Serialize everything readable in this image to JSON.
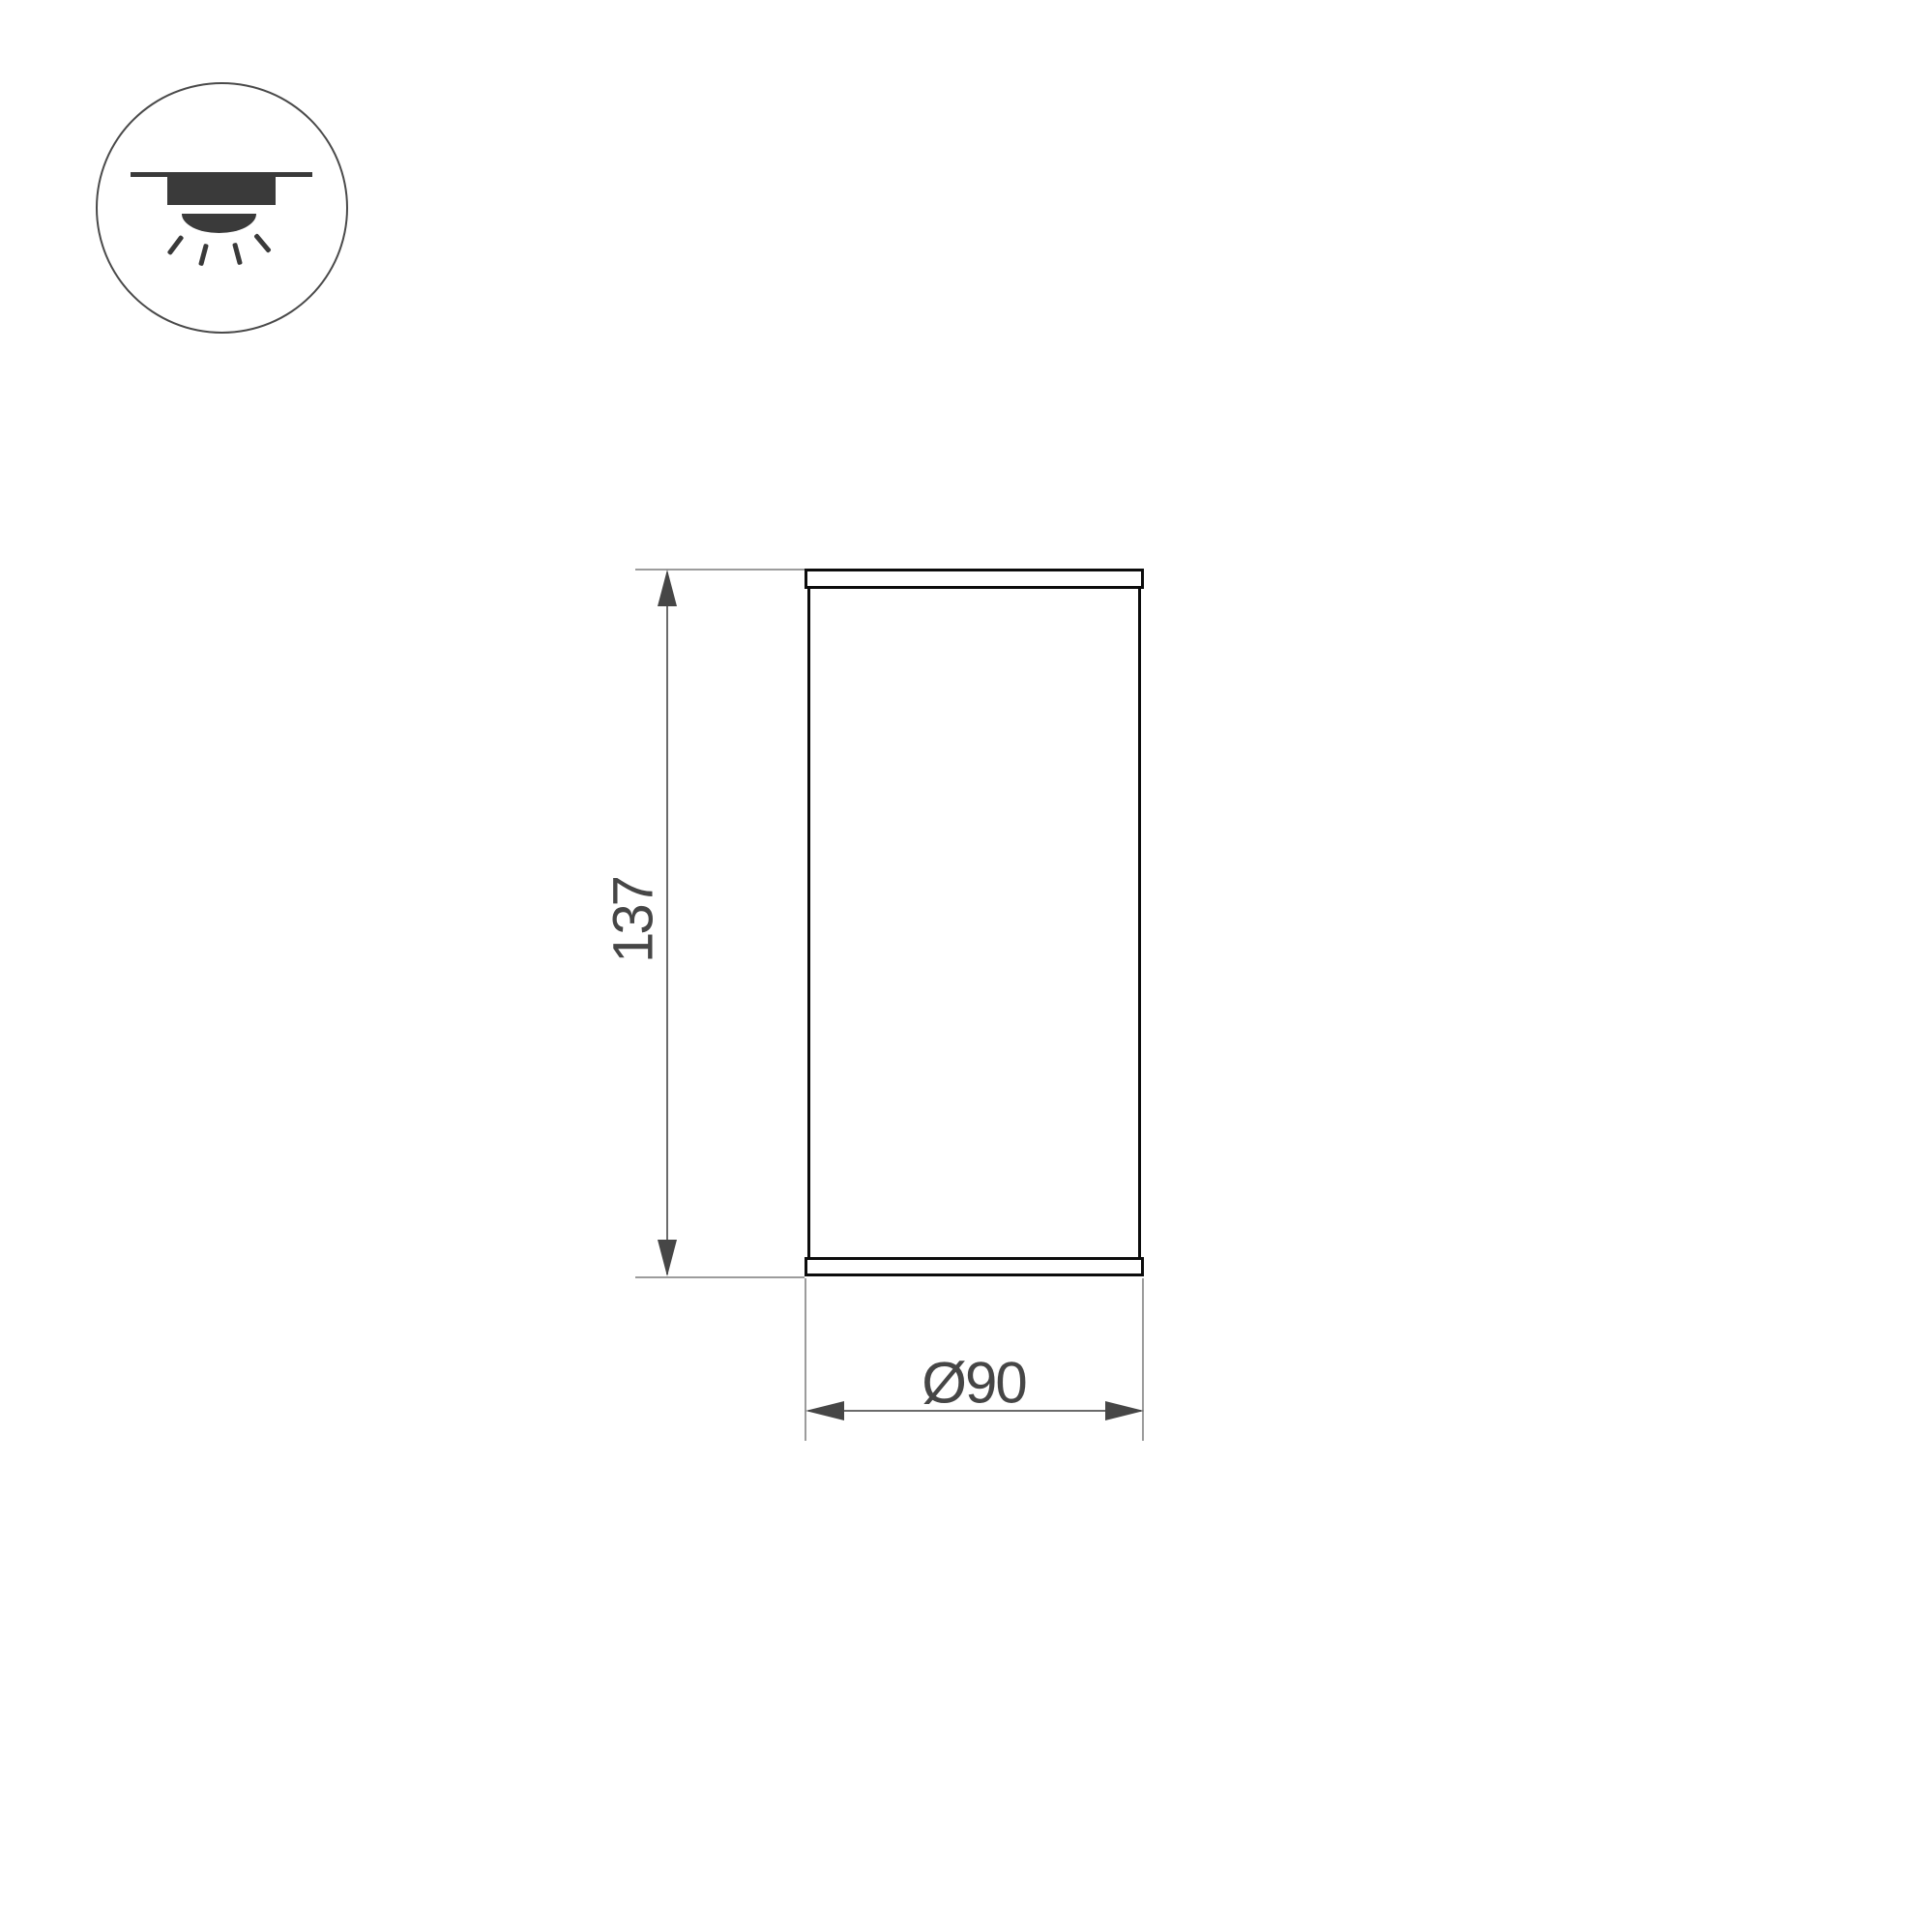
{
  "page": {
    "background_color": "#ffffff",
    "type": "luminaire-dimension-drawing"
  },
  "mount_icon": {
    "name": "surface-mounted-downlight",
    "outline_color": "#4a4a4a",
    "glyph_color": "#3a3a3a",
    "ray_count": 4
  },
  "drawing": {
    "height_label": "137",
    "diameter_label": "Ø90",
    "outline_color": "#0c0c0c",
    "dimension_arrow_color": "#464646",
    "dimension_line_color": "#6b6b6b",
    "extension_line_color": "#9c9c9c",
    "label_color": "#464646"
  }
}
